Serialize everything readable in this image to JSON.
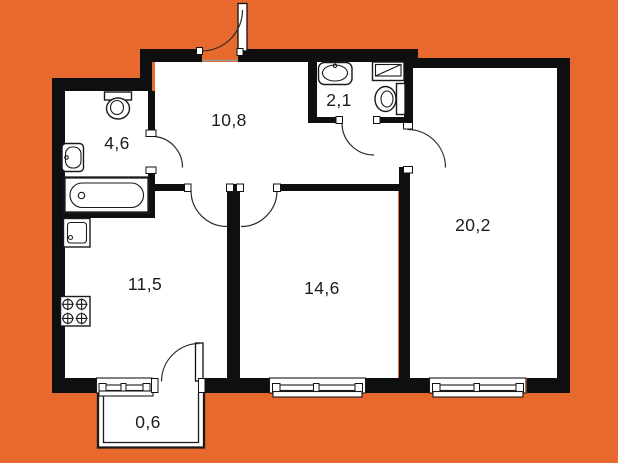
{
  "plan": {
    "colors": {
      "background": "#E8692E",
      "walls": "#0F0F0F",
      "floor": "#FFFFFF",
      "lines": "#1A1A1A",
      "text": "#1C1C1C"
    },
    "rooms": {
      "hallway": {
        "area": "10,8"
      },
      "bathroom": {
        "area": "4,6"
      },
      "wc": {
        "area": "2,1"
      },
      "kitchen": {
        "area": "11,5"
      },
      "bedroom": {
        "area": "14,6"
      },
      "living": {
        "area": "20,2"
      },
      "balcony": {
        "area": "0,6"
      }
    }
  }
}
